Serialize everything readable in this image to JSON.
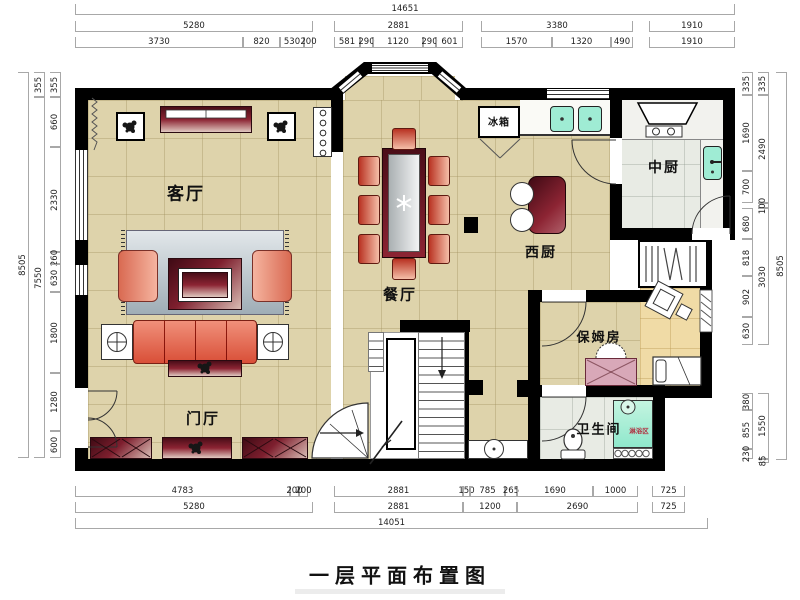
{
  "title": "一层平面布置图",
  "rooms": {
    "living": "客厅",
    "dining": "餐厅",
    "foyer": "门厅",
    "west_kitchen": "西厨",
    "main_kitchen": "中厨",
    "nanny_room": "保姆房",
    "bathroom": "卫生间",
    "fridge": "冰箱",
    "shower_zone": "淋浴区"
  },
  "dimensions": {
    "top": {
      "overall": [
        "14651"
      ],
      "groups": [
        "5280",
        "2881",
        "3380",
        "1910"
      ],
      "details": [
        "3730",
        "820",
        "530",
        "200",
        "581",
        "290",
        "1120",
        "290",
        "601",
        "1570",
        "1320",
        "490",
        "1910"
      ]
    },
    "bottom": {
      "details": [
        "4783",
        "200",
        "200",
        "2881",
        "150",
        "785",
        "265",
        "1690",
        "1000",
        "725"
      ],
      "groups": [
        "5280",
        "2881",
        "1200",
        "2690",
        "725"
      ],
      "overall": [
        "14051"
      ]
    },
    "left": {
      "details": [
        "355",
        "660",
        "2330",
        "260",
        "630",
        "1800",
        "1280",
        "600"
      ],
      "groups": [
        "355",
        "7550"
      ],
      "overall": [
        "8505"
      ]
    },
    "right": {
      "details": [
        "335",
        "1690",
        "700",
        "680",
        "818",
        "902",
        "630",
        "380",
        "855",
        "230"
      ],
      "groups": [
        "335",
        "2490",
        "100",
        "3030",
        "1550",
        "85"
      ],
      "overall": [
        "8505"
      ]
    }
  },
  "colors": {
    "wall": "#000000",
    "floor_beige": "#ded3ab",
    "floor_kitchen": "#e8ebe4",
    "floor_nook": "#f0dba6",
    "furniture_maroon": "#7e1f2e",
    "sofa_red": "#e4634a",
    "sink_teal": "#9fecd4",
    "shower_teal": "#a9eed6",
    "dim_text": "#222222"
  }
}
